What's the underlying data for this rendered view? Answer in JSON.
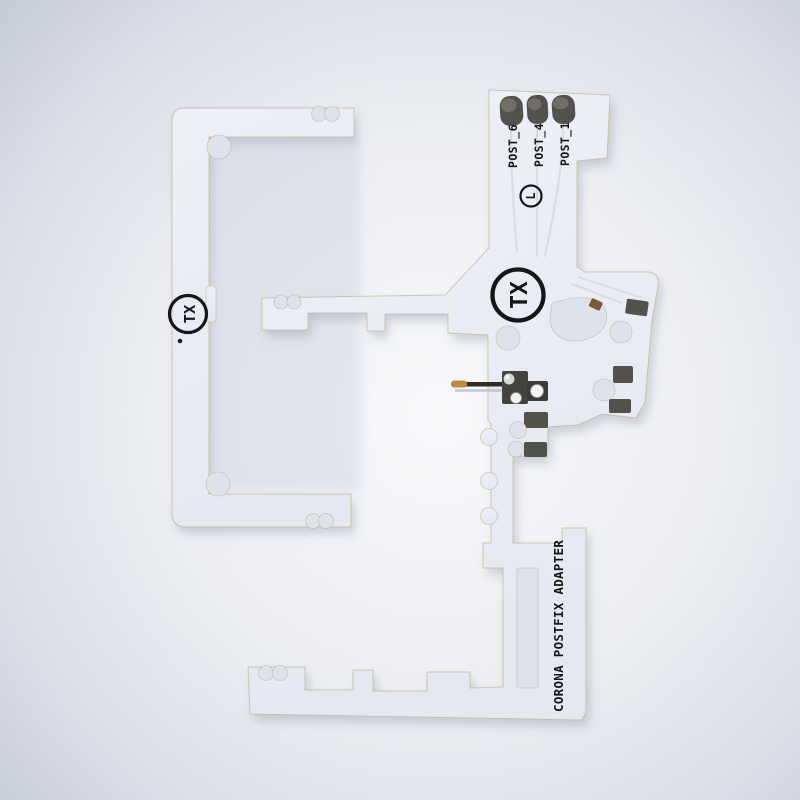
{
  "photo": {
    "subject": "White PCB mod-chip adapter photographed on a light gray background",
    "background_center_color": "#f6f7f9",
    "background_edge_color": "#c4cad7"
  },
  "pcb": {
    "board_color": "#eaedf4",
    "edge_color": "#c8b894",
    "silkscreen_color": "#161616",
    "pad_color": "#53514b",
    "pin_tip_color": "#bd8b41",
    "labels": {
      "post_6": "POST_6",
      "post_4": "POST_4",
      "post_1": "POST_1",
      "logo_l": "L",
      "logo_tx": "TX",
      "title": "CORONA POSTFIX ADAPTER"
    }
  }
}
